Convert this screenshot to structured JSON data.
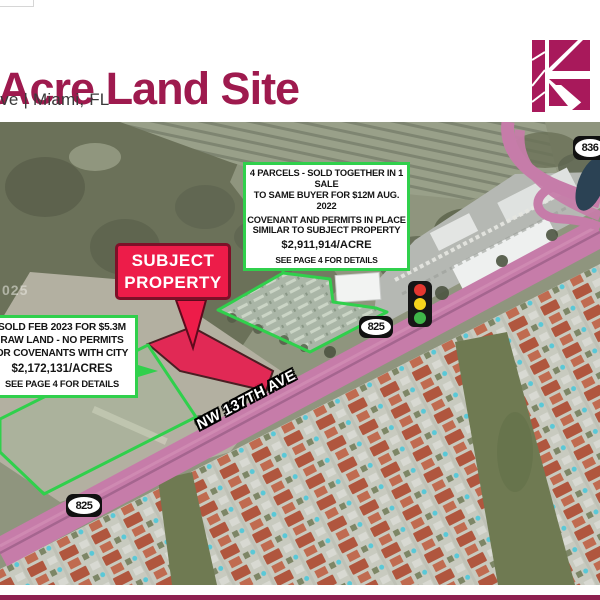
{
  "header": {
    "title": "Acre Land Site",
    "subtitle": "Ave | Miami, FL"
  },
  "logo": {
    "name": "keyes-k-logo",
    "color": "#a8195b"
  },
  "map": {
    "watermark": "025",
    "subject_label": {
      "line1": "SUBJECT",
      "line2": "PROPERTY"
    },
    "callout_parcels": {
      "lines": [
        "4 PARCELS - SOLD TOGETHER IN 1 SALE",
        "TO SAME BUYER FOR $12M AUG. 2022",
        "COVENANT AND PERMITS IN PLACE",
        "SIMILAR TO SUBJECT PROPERTY"
      ],
      "price": "$2,911,914/ACRE",
      "footer": "SEE PAGE 4 FOR DETAILS"
    },
    "callout_sold": {
      "lines": [
        "SOLD FEB 2023 FOR $5.3M",
        "RAW LAND - NO PERMITS",
        "OR COVENANTS WITH CITY"
      ],
      "price": "$2,172,131/ACRES",
      "footer": "SEE PAGE 4 FOR DETAILS"
    },
    "road_label": "NW 137TH AVE",
    "shields": {
      "sr825_upper": "825",
      "sr825_lower": "825",
      "sr836": "836"
    }
  },
  "colors": {
    "title_maroon": "#9e1a4e",
    "logo_maroon": "#a8195b",
    "annotation_green": "#30d04c",
    "subject_red": "#ed1c49",
    "road_pink": "#c67ca9",
    "bottom_bar": "#8e2150"
  }
}
